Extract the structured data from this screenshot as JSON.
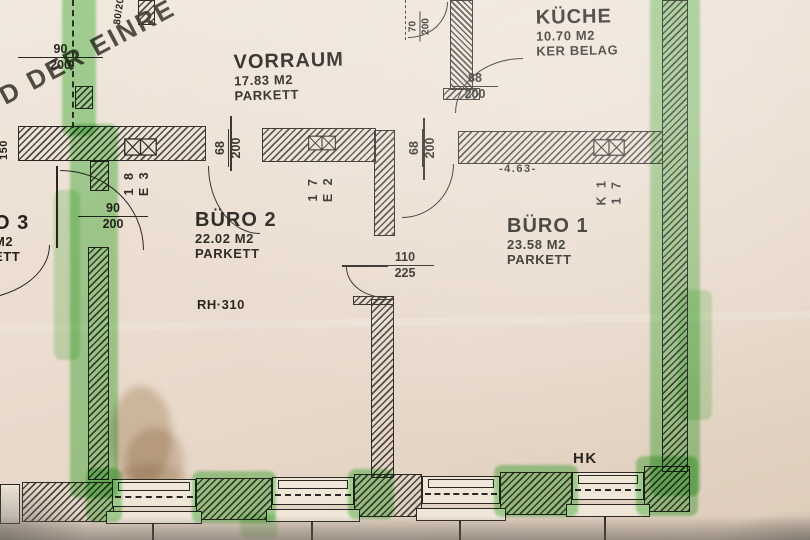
{
  "stamp": {
    "text": "D DER EINRE"
  },
  "rooms": {
    "vorraum": {
      "name": "VORRAUM",
      "area": "17.83 M2",
      "floor": "PARKETT"
    },
    "kueche": {
      "name": "KÜCHE",
      "area": "10.70 M2",
      "floor": "KER BELAG"
    },
    "buero2": {
      "name": "BÜRO 2",
      "area": "22.02 M2",
      "floor": "PARKETT"
    },
    "buero1": {
      "name": "BÜRO 1",
      "area": "23.58 M2",
      "floor": "PARKETT"
    },
    "buero3": {
      "name_fragment": "O 3",
      "area_fragment": "M2",
      "floor_fragment": "ETT"
    }
  },
  "annotations": {
    "room_height": "RH·310",
    "radiator": "HK",
    "overall_width": "-4.63-",
    "edge_left_dim": "150",
    "edge_top_dim": "80/200"
  },
  "door_dimensions": {
    "entry_top_left": {
      "num": "90",
      "den": "200"
    },
    "buero3_door": {
      "num": "90",
      "den": "200"
    },
    "top_small_door": {
      "num": "70",
      "den": "200"
    },
    "kueche_door": {
      "num": "88",
      "den": "200"
    },
    "door_e3": {
      "num": "68",
      "den": "200"
    },
    "door_e2": {
      "num": "68",
      "den": "200"
    },
    "buero_connecting_door": {
      "num": "110",
      "den": "225"
    }
  },
  "unit_codes": {
    "e3": {
      "line1": "1 8",
      "line2": "E 3"
    },
    "e2": {
      "line1": "1 7",
      "line2": "E 2"
    },
    "k1": {
      "line1": "K 1",
      "line2": "1 7"
    }
  }
}
